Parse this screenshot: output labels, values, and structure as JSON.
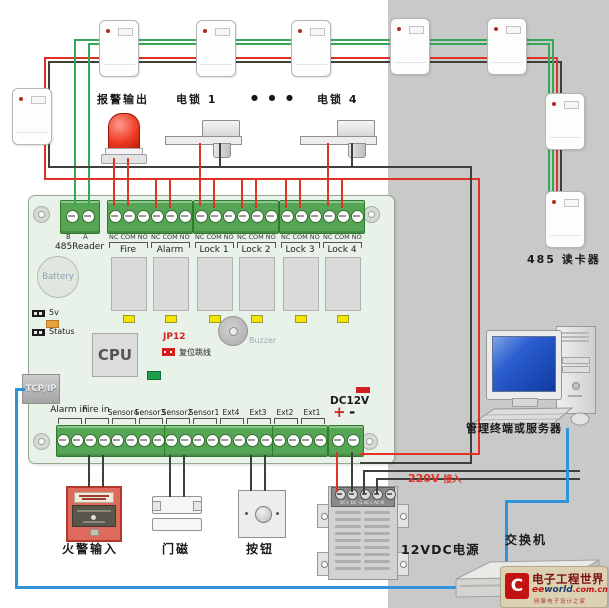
{
  "colors": {
    "wire_green": "#33a857",
    "wire_red": "#e03325",
    "wire_black": "#3f3f3f",
    "wire_blue": "#2e93d8",
    "board_green": "#e9f2e8",
    "terminal_green": "#55a555",
    "accent_red": "#d21f1f",
    "panel_gray": "#c9c9c9"
  },
  "top": {
    "alarm_output_label": "报警输出",
    "lock1_label": "电锁 1",
    "ellipsis": "●  ●  ●",
    "lock4_label": "电锁 4",
    "reader_chain_label": "485 读卡器"
  },
  "board": {
    "reader_port": {
      "pin_b": "B",
      "pin_a": "A",
      "label": "485Reader"
    },
    "pin_header": "NC COM NO",
    "relay_groups": [
      "Fire",
      "Alarm",
      "Lock 1",
      "Lock 2",
      "Lock 3",
      "Lock 4"
    ],
    "battery": "Battery",
    "led_5v": "5v",
    "led_status": "Status",
    "cpu": "CPU",
    "jp12": "JP12",
    "jp12_desc": "复位跳线",
    "buzzer": "Buzzer",
    "tcpip": "TCP/IP",
    "input_groups": [
      {
        "label": "Alarm in",
        "big": true
      },
      {
        "label": "Fire in",
        "big": true
      },
      {
        "label": "Sensor4"
      },
      {
        "label": "Sensor3"
      },
      {
        "label": "Sensor2"
      },
      {
        "label": "Sensor1"
      },
      {
        "label": "Ext4"
      },
      {
        "label": "Ext3"
      },
      {
        "label": "Ext2"
      },
      {
        "label": "Ext1"
      }
    ],
    "dc12v": {
      "label": "DC12V",
      "plus": "+",
      "minus": "-"
    }
  },
  "devices": {
    "fire_input": "火警输入",
    "door_contact": "门磁",
    "exit_button": "按钮",
    "psu": "12VDC电源",
    "ac_input_v": "220V",
    "ac_input_txt": "接入",
    "switch": "交换机",
    "computer": "管理终端或服务器"
  },
  "psu_terminals": "DC+  DC-  G  AC-L  AC-N",
  "watermark": {
    "logo_letter": "C",
    "brand": "电子工程世界",
    "site_ee": "ee",
    "site_world": "world",
    "site_suffix": ".com.cn",
    "tagline": "网聚电子设计之家"
  }
}
